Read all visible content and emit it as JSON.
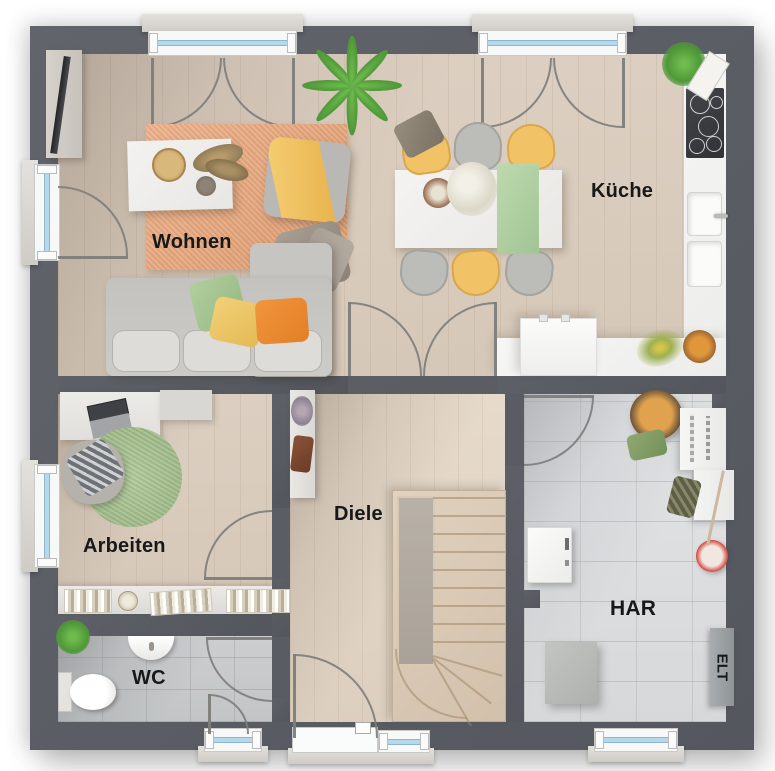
{
  "rooms": {
    "wohnen": {
      "label": "Wohnen"
    },
    "kueche": {
      "label": "Küche"
    },
    "arbeiten": {
      "label": "Arbeiten"
    },
    "diele": {
      "label": "Diele"
    },
    "wc": {
      "label": "WC"
    },
    "har": {
      "label": "HAR"
    },
    "elt": {
      "label": "ELT"
    }
  },
  "colors": {
    "wall": "#585c62",
    "floor_wood": "#d9cbbc",
    "floor_wood_light": "#e3d7c8",
    "floor_tile_har": "#dcdee0",
    "floor_tile_wc": "#c7cacb",
    "kitchen_counter": "#f4f4f2",
    "rug_living": "#e5a67c",
    "rug_office": "#a8c291",
    "sofa_gray": "#c8c7c3",
    "chair_yellow": "#f2c266",
    "pillow_green": "#a9c795",
    "pillow_yellow": "#f1cd6d",
    "pillow_orange": "#ee8f35",
    "table_runner_green": "#b3d3a5",
    "plant_green": "#5fa844",
    "window_glass": "#b5d8ed",
    "bucket_red": "#d6453f"
  }
}
